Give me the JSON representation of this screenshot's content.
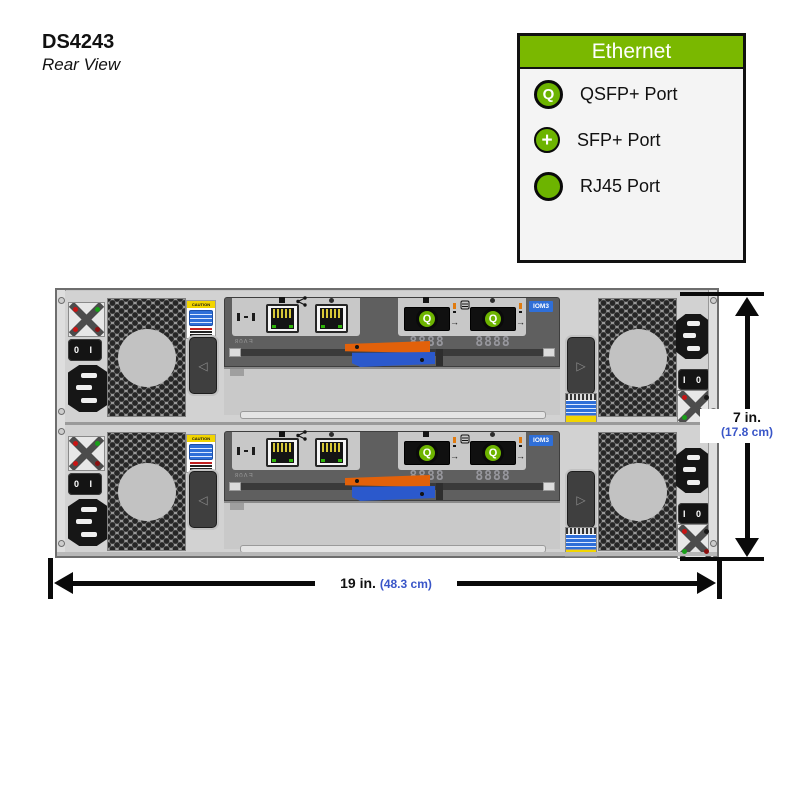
{
  "title": {
    "product": "DS4243",
    "view": "Rear View"
  },
  "legend": {
    "header": "Ethernet",
    "items": [
      {
        "icon": "qsfp-port-icon",
        "glyph": "Q",
        "label": "QSFP+ Port"
      },
      {
        "icon": "sfp-port-icon",
        "glyph": "+",
        "label": "SFP+ Port"
      },
      {
        "icon": "rj45-port-icon",
        "glyph": "",
        "label": "RJ45 Port"
      }
    ]
  },
  "dimensions": {
    "height": {
      "primary": "7 in.",
      "secondary": "(17.8 cm)"
    },
    "width": {
      "primary": "19 in. ",
      "secondary": "(48.3 cm)"
    }
  },
  "chassis": {
    "iom_label": "IOM3",
    "display_digits": "8888",
    "module_code": "EV08",
    "switch_left": "0 I",
    "switch_right": "I 0",
    "caution_label": "CAUTION",
    "port_glyph": "Q"
  },
  "colors": {
    "legend_green": "#7ab800",
    "port_green": "#6db400",
    "dimension_blue": "#3a56c8",
    "cam_orange": "#e2610a",
    "cam_blue": "#2b59cc",
    "label_blue": "#2f6fd8"
  }
}
